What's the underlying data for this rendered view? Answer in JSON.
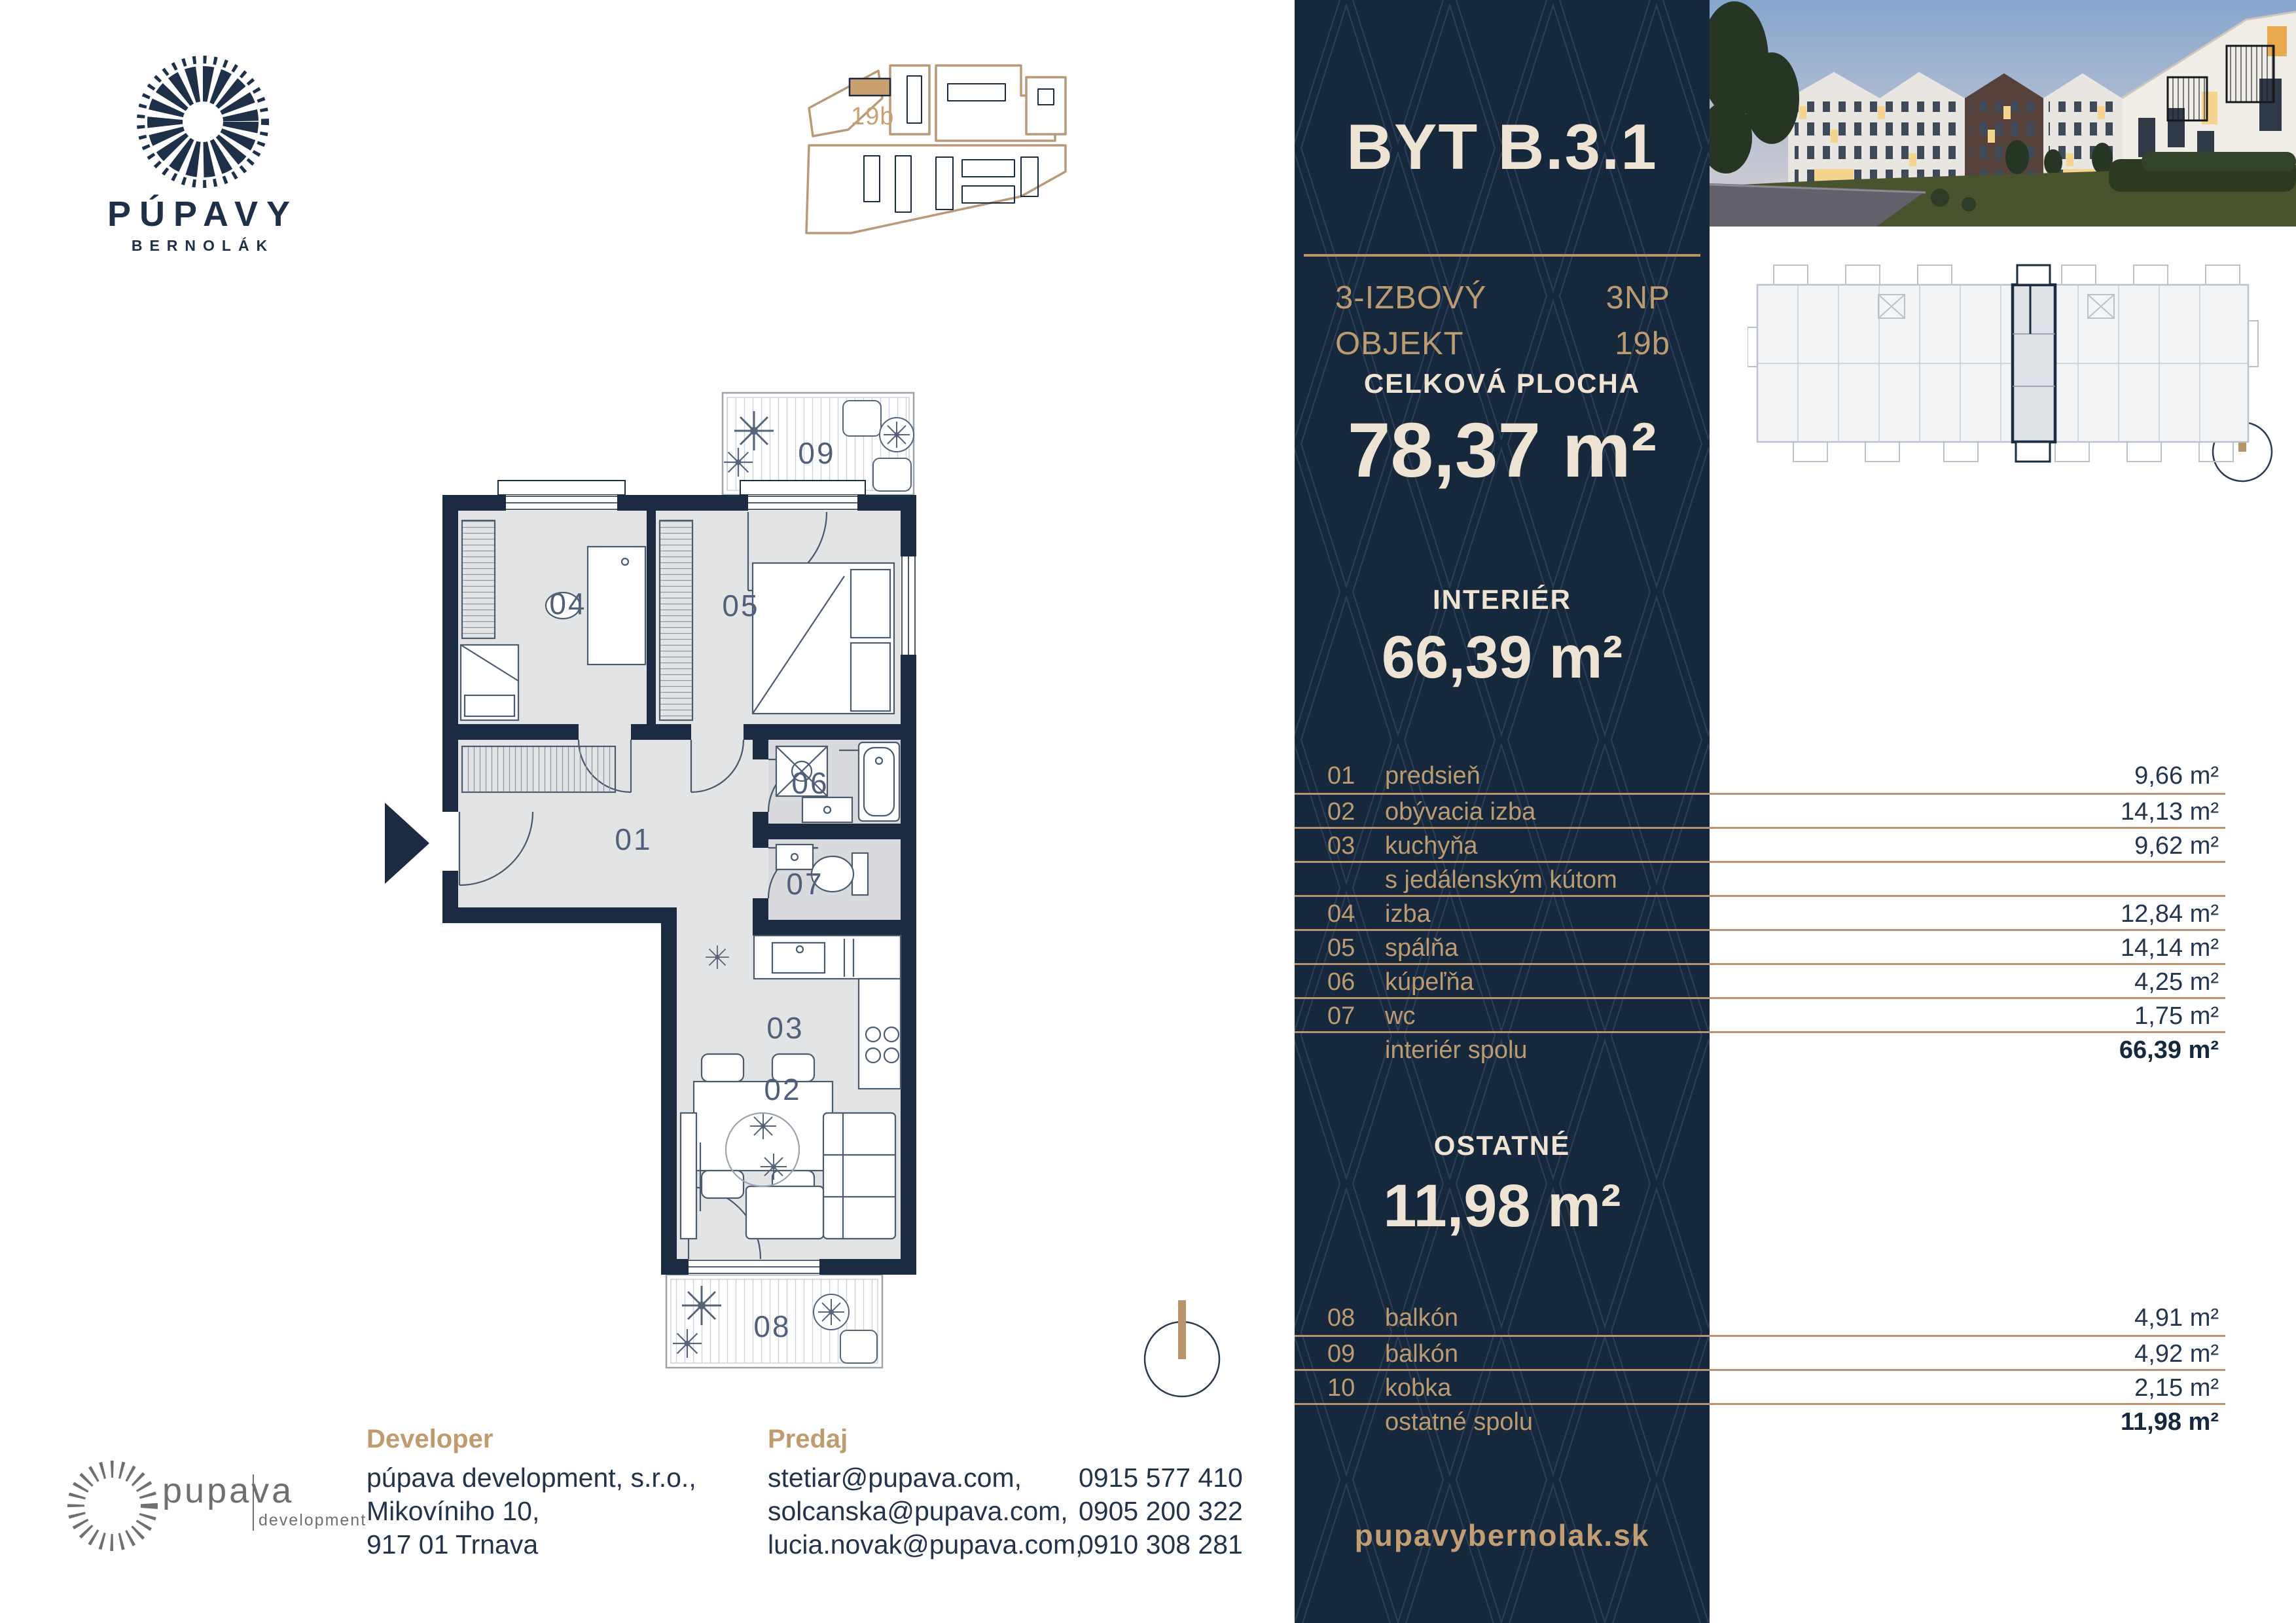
{
  "brand": {
    "wordmark": "PÚPAVY",
    "subtitle": "BERNOLÁK"
  },
  "site_plan": {
    "building_label": "19b",
    "highlight_color": "#C9A06F"
  },
  "unit": {
    "title": "BYT B.3.1",
    "type_line1": "3-IZBOVÝ",
    "type_line2": "OBJEKT",
    "floor": "3NP",
    "building": "19b"
  },
  "total_area": {
    "label": "CELKOVÁ PLOCHA",
    "value": "78,37 m²"
  },
  "interior": {
    "label": "INTERIÉR",
    "value": "66,39 m²",
    "rows": [
      {
        "num": "01",
        "label": "predsieň",
        "value": "9,66 m²"
      },
      {
        "num": "02",
        "label": "obývacia izba",
        "value": "14,13 m²"
      },
      {
        "num": "03",
        "label": "kuchyňa",
        "value": "9,62 m²"
      },
      {
        "num": "",
        "label": "s jedálenským kútom",
        "value": ""
      },
      {
        "num": "04",
        "label": "izba",
        "value": "12,84 m²"
      },
      {
        "num": "05",
        "label": "spálňa",
        "value": "14,14 m²"
      },
      {
        "num": "06",
        "label": "kúpeľňa",
        "value": "4,25 m²"
      },
      {
        "num": "07",
        "label": "wc",
        "value": "1,75 m²"
      },
      {
        "num": "",
        "label": "interiér spolu",
        "value": "66,39 m²"
      }
    ]
  },
  "other": {
    "label": "OSTATNÉ",
    "value": "11,98 m²",
    "rows": [
      {
        "num": "08",
        "label": "balkón",
        "value": "4,91 m²"
      },
      {
        "num": "09",
        "label": "balkón",
        "value": "4,92 m²"
      },
      {
        "num": "10",
        "label": "kobka",
        "value": "2,15 m²"
      },
      {
        "num": "",
        "label": "ostatné spolu",
        "value": "11,98 m²"
      }
    ]
  },
  "website": "pupavybernolak.sk",
  "developer": {
    "heading": "Developer",
    "line1": "púpava development, s.r.o.,",
    "line2": "Mikovíniho 10,",
    "line3": "917 01 Trnava"
  },
  "sales": {
    "heading": "Predaj",
    "email1": "stetiar@pupava.com,",
    "email2": "solcanska@pupava.com,",
    "email3": "lucia.novak@pupava.com,",
    "phone1": "0915 577 410",
    "phone2": "0905 200 322",
    "phone3": "0910 308 281"
  },
  "dev_logo": {
    "main": "pupava",
    "sub": "development"
  },
  "floor_plan": {
    "labels": {
      "r01": "01",
      "r02": "02",
      "r03": "03",
      "r04": "04",
      "r05": "05",
      "r06": "06",
      "r07": "07",
      "r08": "08",
      "r09": "09"
    }
  },
  "colors": {
    "panel_bg": "#16283B",
    "pattern_line": "#2C3F57",
    "cream": "#EFE3D4",
    "tan": "#BD9B72",
    "line_tan": "#B7946B",
    "wall_navy": "#1B2C42",
    "room_gray": "#E3E4E6",
    "bath_gray": "#D8DADD"
  }
}
